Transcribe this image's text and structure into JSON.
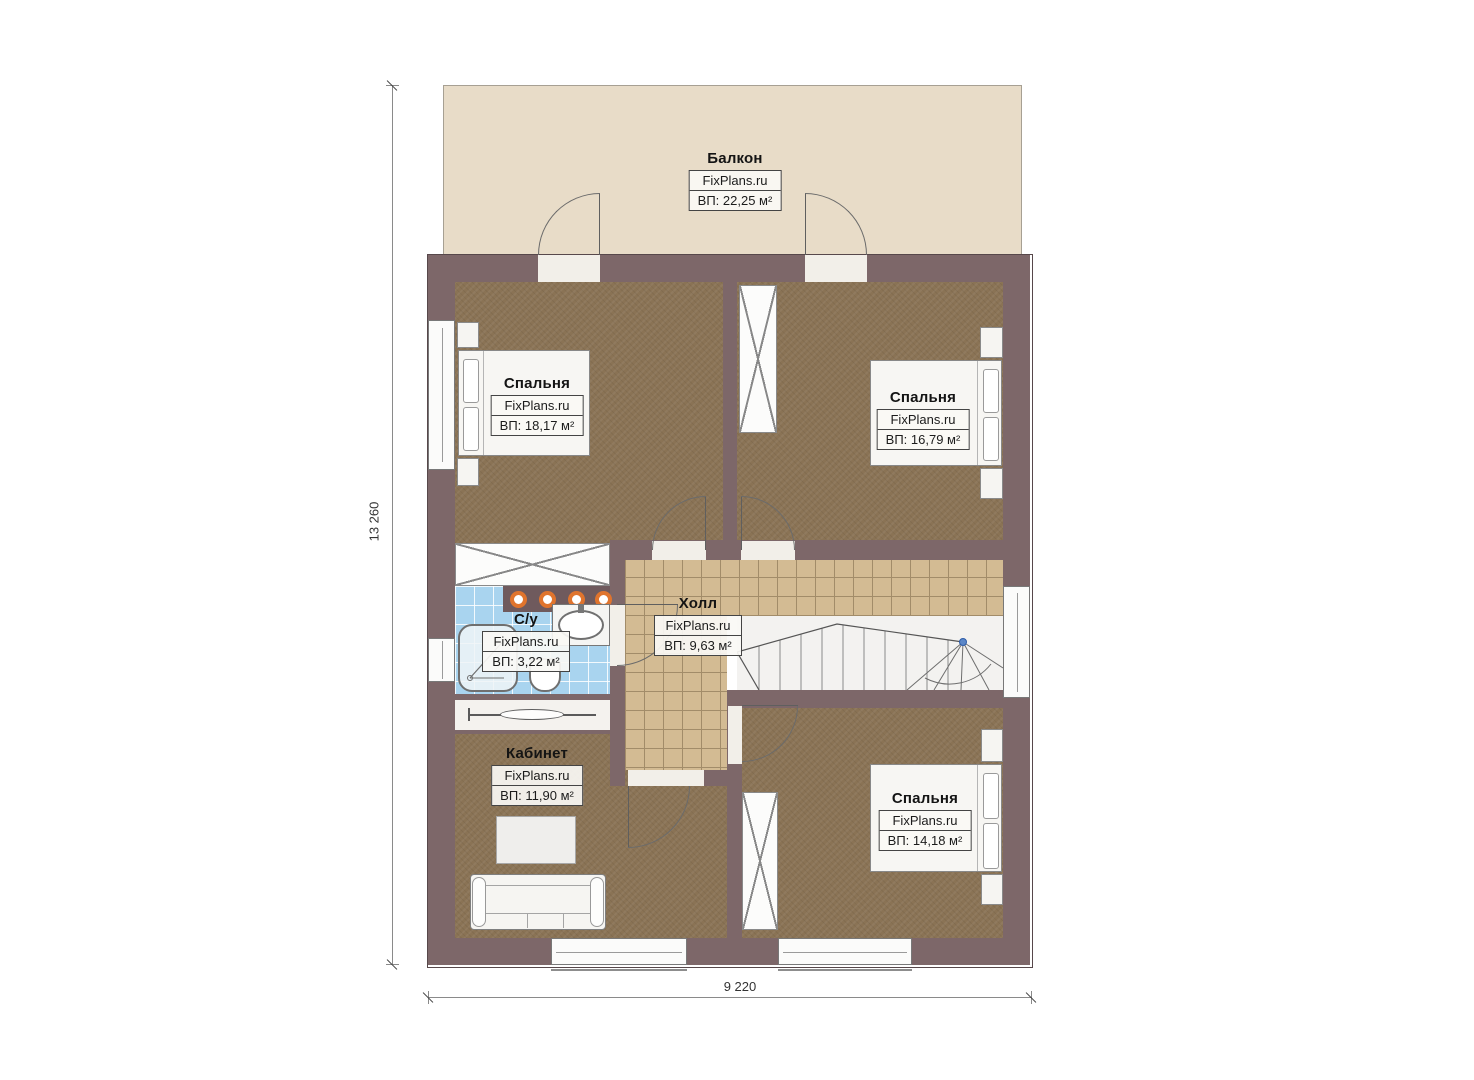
{
  "rooms": [
    {
      "id": "balcony",
      "name": "Балкон",
      "brand": "FixPlans.ru",
      "area": "ВП: 22,25 м²"
    },
    {
      "id": "bedroom-tl",
      "name": "Спальня",
      "brand": "FixPlans.ru",
      "area": "ВП: 18,17 м²"
    },
    {
      "id": "bedroom-tr",
      "name": "Спальня",
      "brand": "FixPlans.ru",
      "area": "ВП: 16,79 м²"
    },
    {
      "id": "bathroom",
      "name": "С/у",
      "brand": "FixPlans.ru",
      "area": "ВП: 3,22 м²"
    },
    {
      "id": "hall",
      "name": "Холл",
      "brand": "FixPlans.ru",
      "area": "ВП: 9,63 м²"
    },
    {
      "id": "office",
      "name": "Кабинет",
      "brand": "FixPlans.ru",
      "area": "ВП: 11,90 м²"
    },
    {
      "id": "bedroom-br",
      "name": "Спальня",
      "brand": "FixPlans.ru",
      "area": "ВП: 14,18 м²"
    }
  ],
  "dimensions": {
    "vertical": "13 260",
    "horizontal": "9 220"
  },
  "colors": {
    "wall": "#7d6769",
    "balcony_floor": "#e8dcc8",
    "room_floor": "#8a7355",
    "hall_tile": "#d3bb93",
    "bath_tile": "#a9d4ef",
    "ceiling_light": "#e0742d",
    "stair_node": "#5b87c7"
  }
}
